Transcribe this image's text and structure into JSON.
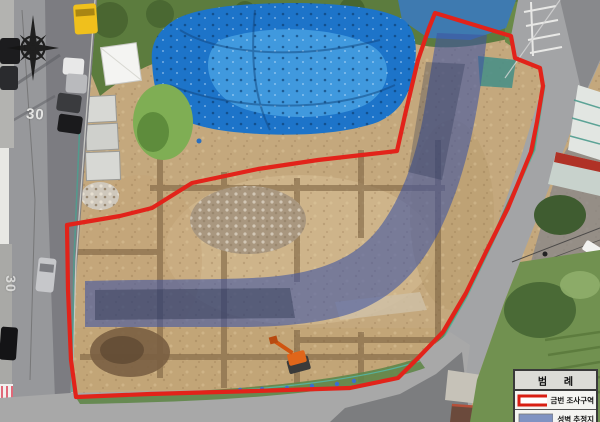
{
  "road_markings": {
    "speed_limit": "30"
  },
  "annotations": {
    "survey_boundary_color": "#e2231a",
    "wall_overlay_color": "#3f55a2",
    "wall_overlay_opacity": "0.6"
  },
  "legend": {
    "title": "범 례",
    "items": [
      {
        "label": "금번 조사구역",
        "swatch_style": "red-outline",
        "swatch_color": "#d81e12",
        "swatch_fill": "#ffffff"
      },
      {
        "label": "성벽 추정지",
        "swatch_style": "blue-fill",
        "swatch_color": "#8093c2"
      }
    ]
  },
  "icons": {
    "compass": "compass-rose"
  }
}
